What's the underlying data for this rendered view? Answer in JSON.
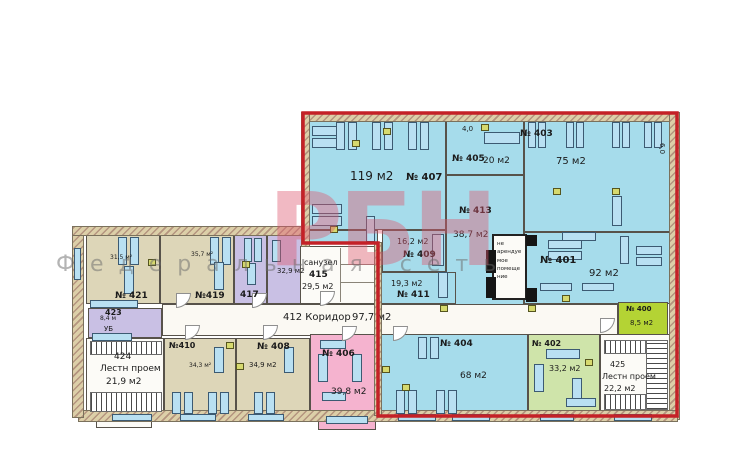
{
  "watermark": {
    "brand": "РБН",
    "subtitle": "Федеральная сеть"
  },
  "dimensions": {
    "top_small": "4,0",
    "right_small": "6,0"
  },
  "corridor": {
    "number_label": "412 Коридор",
    "area": "97,7 м2"
  },
  "rooms": {
    "r400": {
      "number": "№ 400",
      "area": "8,5 м2"
    },
    "r401": {
      "number": "№ 401",
      "area": "92 м2"
    },
    "r402": {
      "number": "№ 402",
      "area": "33,2 м2"
    },
    "r403": {
      "number": "№ 403",
      "area": "75 м2"
    },
    "r404": {
      "number": "№ 404",
      "area": "68 м2"
    },
    "r405": {
      "number": "№ 405",
      "area": "20 м2"
    },
    "r406": {
      "number": "№ 406",
      "area": "39,8 м2"
    },
    "r407": {
      "number": "№ 407",
      "area": "119 м2"
    },
    "r408": {
      "number": "№ 408",
      "area": "34,9 м2"
    },
    "r409": {
      "number": "№ 409",
      "area": "16,2 м2"
    },
    "r410": {
      "number": "№410",
      "area": "34,3 м²"
    },
    "r411": {
      "number": "№ 411",
      "area": "19,3 м2"
    },
    "r413": {
      "number": "№ 413",
      "area": "38,7 м2"
    },
    "r415": {
      "label": "санузел",
      "number": "415",
      "area": "29,5 м2"
    },
    "r417": {
      "number": "417"
    },
    "r418": {
      "area": "32,9 м2"
    },
    "r419": {
      "number": "№419",
      "area": "35,7 м²"
    },
    "r421": {
      "number": "№ 421",
      "area": "31,5 м²"
    },
    "r423": {
      "number": "423",
      "area": "8,4 м",
      "note": "УБ"
    },
    "r424": {
      "number": "424",
      "label": "Лестн проем",
      "area": "21,9 м2"
    },
    "r425": {
      "number": "425",
      "label": "Лестн проем",
      "area": "22,2 м2"
    },
    "nonrentable": {
      "label": "не арендуе мое помеще ние"
    }
  },
  "colors": {
    "highlight_border": "#c42127",
    "room_blue": "#a6dceb",
    "room_beige": "#ddd6b8",
    "room_purple": "#c9c0e4",
    "room_pink": "#f5b3cf",
    "room_green": "#cfe4aa",
    "room_lime": "#b4d334",
    "wall": "#dccfa8"
  }
}
